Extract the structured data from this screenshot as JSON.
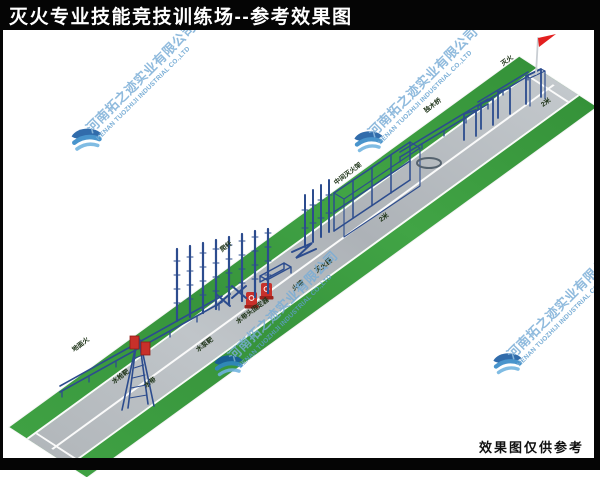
{
  "title_bar": {
    "title": "灭火专业技能竞技训练场--参考效果图"
  },
  "footer": {
    "disclaimer": "效果图仅供参考"
  },
  "watermark": {
    "company_cn": "河南拓之迹实业有限公司",
    "company_en": "HENAN TUOZHIJI INDUSTRIAL CO.,LTD",
    "logo_color_dark": "#1558a0",
    "logo_color_mid": "#2f86c6",
    "logo_color_light": "#6fb3e0"
  },
  "scene": {
    "description": "isometric 3D rendering of a long fire-fighting skills competition training strip",
    "grass_color": "#3fa143",
    "track_color": "#b6bbc0",
    "lane_line_color": "#fafafa",
    "structure_color": "#2c4c8e",
    "target_red": "#c8302a",
    "flag_red": "#e31f1f",
    "ground_labels": [
      {
        "text": "地面火"
      },
      {
        "text": "水枪靶"
      },
      {
        "text": "水带"
      },
      {
        "text": "水泵靶"
      },
      {
        "text": "爬杆"
      },
      {
        "text": "水带头固定器"
      },
      {
        "text": "火墙"
      },
      {
        "text": "灭火器"
      },
      {
        "text": "中间灭火架"
      },
      {
        "text": "2米"
      },
      {
        "text": "独木桥"
      },
      {
        "text": "2米"
      },
      {
        "text": "灭火"
      }
    ],
    "equipment": [
      {
        "name": "low-balance-beam"
      },
      {
        "name": "ladder-tower-with-targets"
      },
      {
        "name": "extinguisher-stands"
      },
      {
        "name": "climbing-poles"
      },
      {
        "name": "cross-obstacles"
      },
      {
        "name": "fire-wall-frame"
      },
      {
        "name": "zigzag-rail"
      },
      {
        "name": "spiked-poles"
      },
      {
        "name": "scaffold-frame"
      },
      {
        "name": "hose-ring"
      },
      {
        "name": "hurdle-racks"
      },
      {
        "name": "balance-beam-2"
      },
      {
        "name": "balance-beam-3"
      },
      {
        "name": "finish-arch"
      },
      {
        "name": "finish-flag"
      }
    ]
  }
}
